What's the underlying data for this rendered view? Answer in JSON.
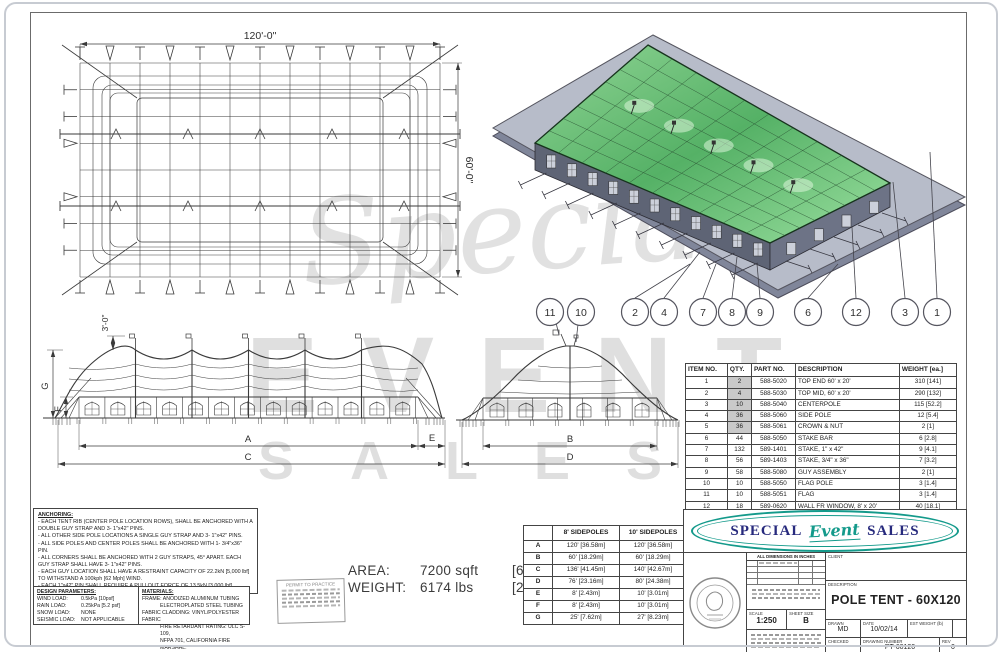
{
  "watermark": {
    "script": "Special",
    "line1": "EVENT",
    "line2": "SALES"
  },
  "plan_view": {
    "width_dim": "120'-0\"",
    "height_dim": "60'-0\""
  },
  "side_view": {
    "flag_dim": "3'-0\"",
    "dims": {
      "a": "A",
      "c": "C",
      "e": "E",
      "f": "F",
      "g": "G"
    }
  },
  "end_view": {
    "dims": {
      "b": "B",
      "d": "D"
    }
  },
  "callouts": [
    "11",
    "10",
    "2",
    "4",
    "7",
    "8",
    "9",
    "6",
    "12",
    "3",
    "1"
  ],
  "parts_table": {
    "headers": [
      "ITEM NO.",
      "QTY.",
      "PART NO.",
      "DESCRIPTION",
      "WEIGHT [ea.]"
    ],
    "rows": [
      [
        "1",
        "2",
        "588-5020",
        "TOP END 60' x 20'",
        "310 [141]"
      ],
      [
        "2",
        "4",
        "588-5030",
        "TOP MID, 60' x 20'",
        "290 [132]"
      ],
      [
        "3",
        "10",
        "588-5040",
        "CENTERPOLE",
        "115 [52.2]"
      ],
      [
        "4",
        "36",
        "588-5060",
        "SIDE POLE",
        "12 [5.4]"
      ],
      [
        "5",
        "36",
        "588-5061",
        "CROWN & NUT",
        "2 [1]"
      ],
      [
        "6",
        "44",
        "588-5050",
        "STAKE BAR",
        "6 [2.8]"
      ],
      [
        "7",
        "132",
        "589-1401",
        "STAKE, 1\" x 42\"",
        "9 [4.1]"
      ],
      [
        "8",
        "56",
        "589-1403",
        "STAKE, 3/4\" x 36\"",
        "7 [3.2]"
      ],
      [
        "9",
        "58",
        "588-5080",
        "GUY ASSEMBLY",
        "2 [1]"
      ],
      [
        "10",
        "10",
        "588-5050",
        "FLAG POLE",
        "3 [1.4]"
      ],
      [
        "11",
        "10",
        "588-5051",
        "FLAG",
        "3 [1.4]"
      ],
      [
        "12",
        "18",
        "589-0620",
        "WALL FR WINDOW, 8' x 20'",
        "40 [18.1]"
      ]
    ],
    "qty_highlight_rows": [
      0,
      1,
      2,
      3,
      4
    ]
  },
  "notes": {
    "anchoring_title": "ANCHORING:",
    "anchoring_lines": [
      "- EACH TENT RIB (CENTER POLE LOCATION ROWS), SHALL BE ANCHORED WITH A DOUBLE GUY STRAP AND 3- 1\"x42\" PINS.",
      "- ALL OTHER SIDE POLE LOCATIONS A SINGLE GUY STRAP AND 3- 1\"x42\" PINS.",
      "- ALL SIDE POLES AND CENTER POLES SHALL BE ANCHORED WITH 1- 3/4\"x36\" PIN.",
      "- ALL CORNERS SHALL BE ANCHORED WITH 2 GUY STRAPS, 45° APART. EACH GUY STRAP SHALL HAVE 3- 1\"x42\" PINS.",
      "- EACH GUY LOCATION SHALL HAVE A RESTRAINT CAPACITY OF 22.2kN [5,000 lbf] TO WITHSTAND A 100kph [62 Mph] WIND.",
      "- EACH 1\"x42\" PIN SHALL REQUIRE A PULLOUT FORCE OF 13.5kN [3,000 lbf]",
      "- EACH 3/4\"x36\" PIN SHALL REQUIRE A PULLOUT FORCE OF 9kN [2,000 lbf]"
    ],
    "installation_note": "*INSTALLATION CREW MUST ENSURE THAT EACH STRUCTURE/INSTALLATION IS PROPERLY SECURED. SITE CONDITIONS MAY REQUIRE ALTERNATE ANCHORING METHODS OR ADDITIONAL ANCHORING.",
    "design_parameters": {
      "title": "DESIGN PARAMETERS:",
      "rows": [
        [
          "WIND LOAD:",
          "0.5kPa [10psf]"
        ],
        [
          "RAIN LOAD:",
          "0.25kPa [5.2 psf]"
        ],
        [
          "SNOW LOAD:",
          "NONE"
        ],
        [
          "SEISMIC LOAD:",
          "NOT APPLICABLE"
        ]
      ]
    },
    "materials": {
      "title": "MATERIALS:",
      "lines": [
        "FRAME: ANODIZED ALUMINUM TUBING",
        "ELECTROPLATED STEEL TUBING",
        "FABRIC CLADDING: VINYL/POLYESTER FABRIC",
        "FIRE RETARDANT RATING: ULC S-109,",
        "NFPA 701, CALIFORNIA FIRE MARSHAL."
      ]
    }
  },
  "permit_stamp": {
    "title": "PERMIT TO PRACTICE"
  },
  "summary": {
    "area_label": "AREA:",
    "area_value": "7200 sqft",
    "area_metric": "[669 sqm]",
    "weight_label": "WEIGHT:",
    "weight_value": "6174 lbs",
    "weight_metric": "[2800 kg]"
  },
  "dim_table": {
    "corner": "",
    "col_8": "8' SIDEPOLES",
    "col_10": "10' SIDEPOLES",
    "rows": [
      [
        "A",
        "120' [36.58m]",
        "120' [36.58m]"
      ],
      [
        "B",
        "60' [18.29m]",
        "60' [18.29m]"
      ],
      [
        "C",
        "136' [41.45m]",
        "140' [42.67m]"
      ],
      [
        "D",
        "76' [23.16m]",
        "80' [24.38m]"
      ],
      [
        "E",
        "8' [2.43m]",
        "10' [3.01m]"
      ],
      [
        "F",
        "8' [2.43m]",
        "10' [3.01m]"
      ],
      [
        "G",
        "25' [7.62m]",
        "27' [8.23m]"
      ]
    ]
  },
  "title_block": {
    "logo": {
      "word1": "SPECIAL",
      "word2": "Event",
      "word3": "SALES"
    },
    "dims_note": "ALL DIMENSIONS IN INCHES",
    "client_label": "CLIENT",
    "description_label": "DESCRIPTION",
    "description_value": "POLE TENT - 60X120",
    "scale_label": "SCALE",
    "scale_value": "1:250",
    "sheet_size_label": "SHEET SIZE",
    "sheet_size_value": "B",
    "drawn_label": "DRAWN",
    "drawn_value": "MD",
    "date_label": "DATE",
    "date_value": "10/02/14",
    "est_weight_label": "EST WEIGHT (lb)",
    "est_weight_value": "",
    "checked_label": "CHECKED",
    "checked_value": "",
    "drawing_number_label": "DRAWING NUMBER",
    "drawing_number_value": "PT-60120",
    "rev_label": "REV",
    "rev_value": "0"
  },
  "colors": {
    "accent_teal": "#149a8b",
    "navy": "#272a7d",
    "roof_green": "#5cb768",
    "line": "#3a3a3a",
    "watermark": "#dcdcdc",
    "qty_highlight": "#c9c9c9"
  }
}
